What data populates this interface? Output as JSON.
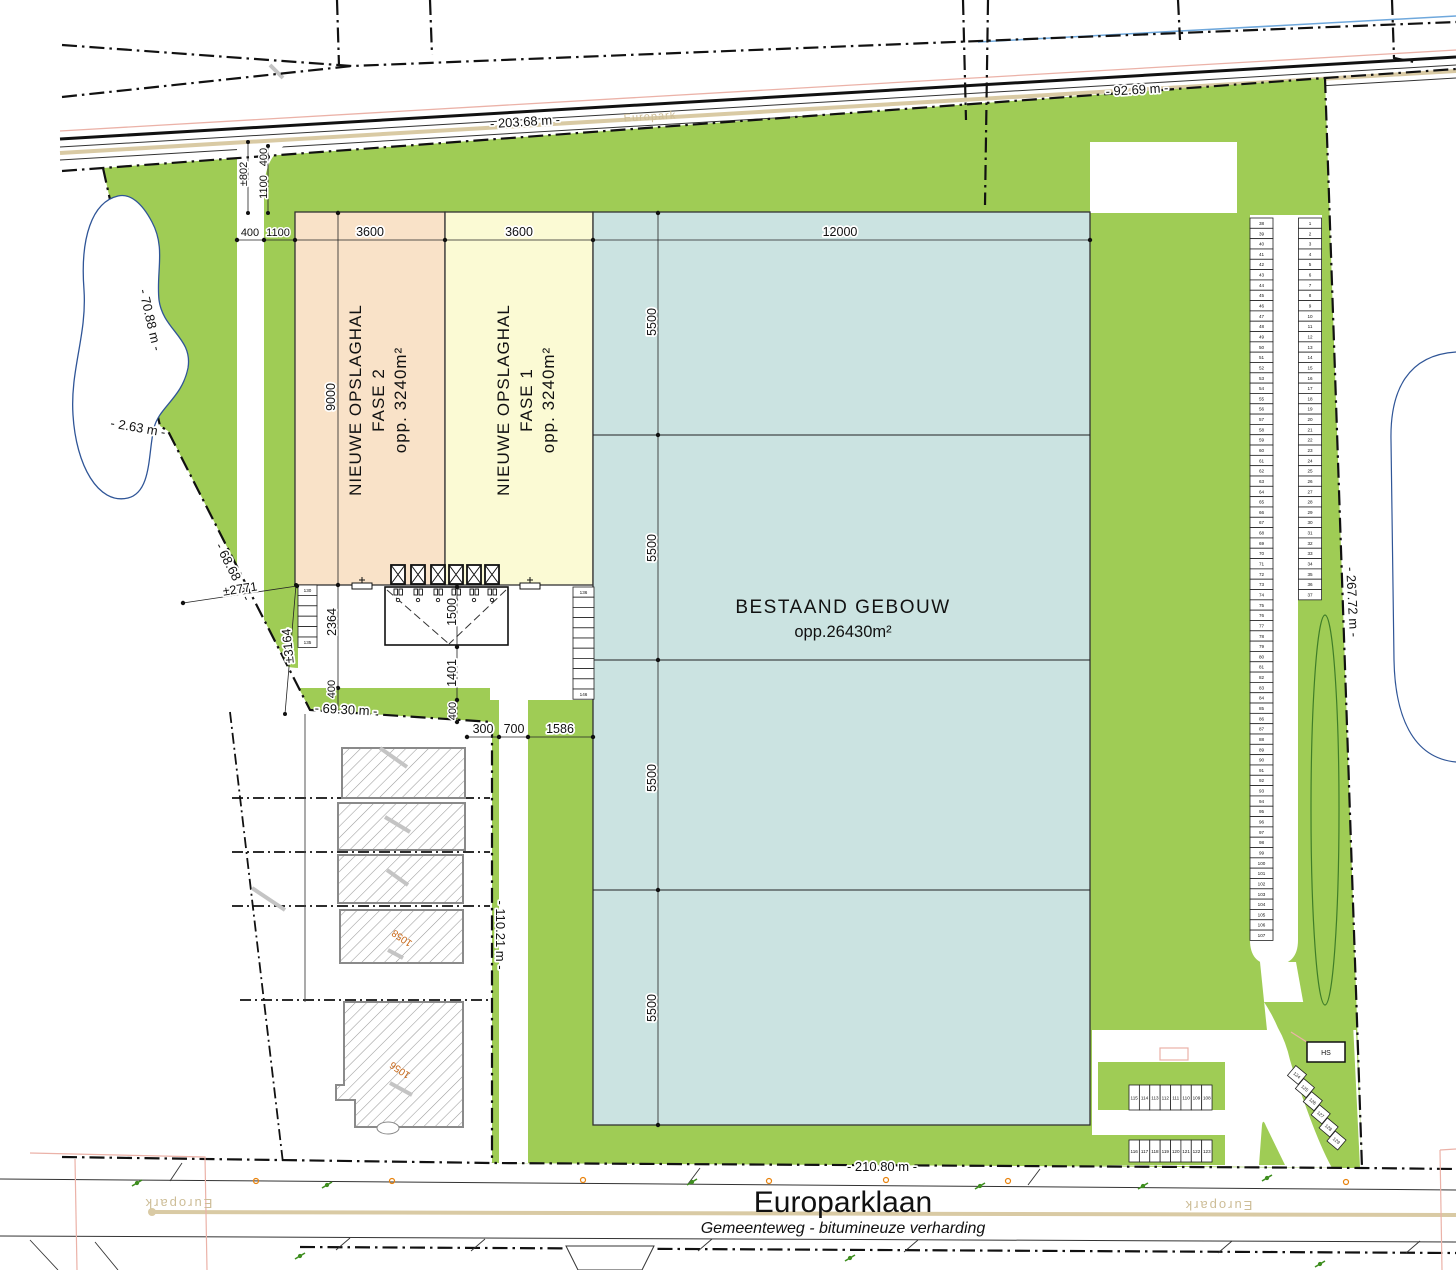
{
  "plan": {
    "dims": {
      "m203": "- 203.68 m -",
      "m92": "- 92.69 m -",
      "m70": "- 70.88 m -",
      "m2": "- 2.63 m -",
      "m68": "- 68.68 m -",
      "m69": "- 69.30 m -",
      "m110": "- 110.21 m -",
      "m210": "- 210.80 m -",
      "m267": "- 267.72 m -",
      "w3600a": "3600",
      "w3600b": "3600",
      "w12000": "12000",
      "h5500": [
        "5500",
        "5500",
        "5500",
        "5500"
      ],
      "h9000": "9000",
      "top400": "400",
      "top1100": "1100",
      "v400": "400",
      "v1100": "1100",
      "v802": "±802",
      "s2771": "±2771",
      "s3164": "±3164",
      "s2364": "2364",
      "s400": "400",
      "dock1500": "1500",
      "dock1401": "1401",
      "dock400": "400",
      "b300": "300",
      "b700": "700",
      "b1586": "1586"
    },
    "buildings": {
      "existing_name": "BESTAAND GEBOUW",
      "existing_area": "opp.26430m²",
      "hall2": [
        "NIEUWE OPSLAGHAL",
        "FASE 2",
        "opp. 3240m²"
      ],
      "hall1": [
        "NIEUWE OPSLAGHAL",
        "FASE 1",
        "opp. 3240m²"
      ]
    },
    "road": {
      "name": "Europarklaan",
      "subtitle": "Gemeenteweg - bitumineuze verharding",
      "basemap_label": "Europark"
    },
    "labels": {
      "hs": "HS",
      "parcel_a": "1058",
      "parcel_b": "1056"
    },
    "parking": {
      "right_column": {
        "from": 1,
        "to": 37
      },
      "left_column": {
        "from": 38,
        "to": 107
      },
      "row_upper": [
        115,
        114,
        113,
        112,
        111,
        110,
        109,
        108
      ],
      "row_lower": [
        116,
        117,
        118,
        119,
        120,
        121,
        122,
        123
      ],
      "diagonal": [
        124,
        125,
        126,
        127,
        128,
        129
      ],
      "stack_left": {
        "count": 6,
        "top": "130",
        "bottom": "135"
      },
      "stack_right": {
        "count": 11,
        "top": "136",
        "bottom": "146"
      }
    },
    "colors": {
      "green": "#9FCC55",
      "teal": "#CBE3E1",
      "peach": "#F9E2C8",
      "lightyellow": "#FBFAD4",
      "tan": "#D9CAA4",
      "pink": "#EBB2A8",
      "waterblue": "#2F5597",
      "skyblue": "#6FA8DC"
    }
  }
}
